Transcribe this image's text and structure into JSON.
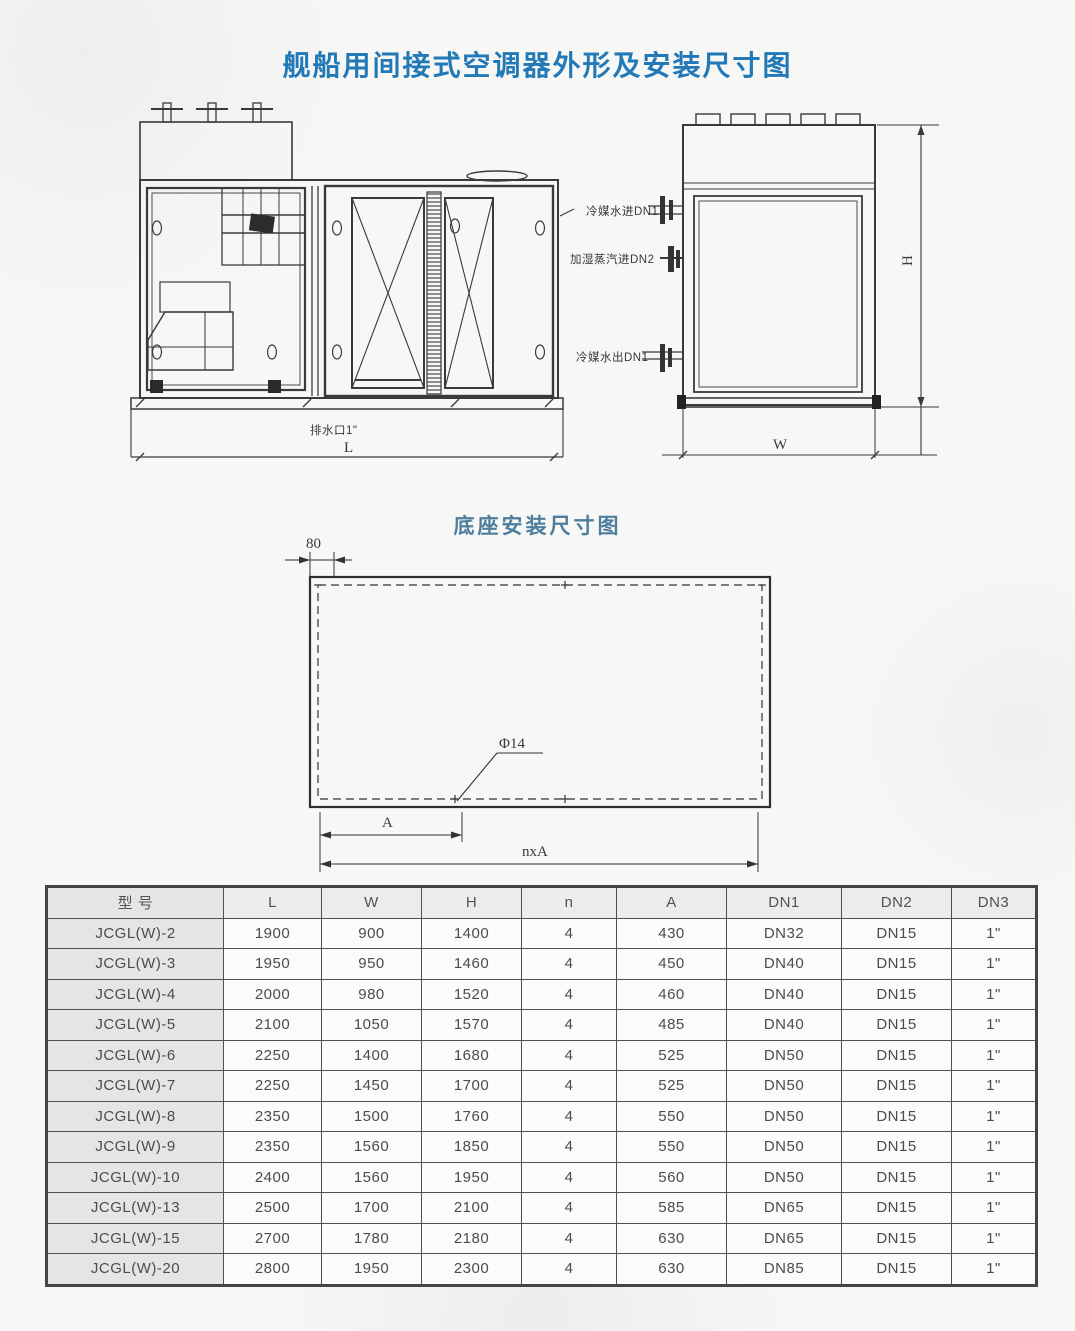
{
  "page": {
    "main_title": "舰船用间接式空调器外形及安装尺寸图",
    "base_drawing_title": "底座安装尺寸图"
  },
  "outline_drawing": {
    "port_labels": {
      "chilled_water_inlet": "冷媒水进DN1",
      "humidify_steam_inlet": "加湿蒸汽进DN2",
      "chilled_water_outlet": "冷媒水出DN1",
      "drain_port": "排水口1\""
    },
    "dim_labels": {
      "length": "L",
      "width": "W",
      "height": "H"
    }
  },
  "base_drawing": {
    "dim_labels": {
      "edge_offset": "80",
      "hole_diameter": "Φ14",
      "hole_pitch": "A",
      "total_span": "nxA"
    }
  },
  "spec_table": {
    "headers": [
      "型  号",
      "L",
      "W",
      "H",
      "n",
      "A",
      "DN1",
      "DN2",
      "DN3"
    ],
    "rows": [
      [
        "JCGL(W)-2",
        "1900",
        "900",
        "1400",
        "4",
        "430",
        "DN32",
        "DN15",
        "1\""
      ],
      [
        "JCGL(W)-3",
        "1950",
        "950",
        "1460",
        "4",
        "450",
        "DN40",
        "DN15",
        "1\""
      ],
      [
        "JCGL(W)-4",
        "2000",
        "980",
        "1520",
        "4",
        "460",
        "DN40",
        "DN15",
        "1\""
      ],
      [
        "JCGL(W)-5",
        "2100",
        "1050",
        "1570",
        "4",
        "485",
        "DN40",
        "DN15",
        "1\""
      ],
      [
        "JCGL(W)-6",
        "2250",
        "1400",
        "1680",
        "4",
        "525",
        "DN50",
        "DN15",
        "1\""
      ],
      [
        "JCGL(W)-7",
        "2250",
        "1450",
        "1700",
        "4",
        "525",
        "DN50",
        "DN15",
        "1\""
      ],
      [
        "JCGL(W)-8",
        "2350",
        "1500",
        "1760",
        "4",
        "550",
        "DN50",
        "DN15",
        "1\""
      ],
      [
        "JCGL(W)-9",
        "2350",
        "1560",
        "1850",
        "4",
        "550",
        "DN50",
        "DN15",
        "1\""
      ],
      [
        "JCGL(W)-10",
        "2400",
        "1560",
        "1950",
        "4",
        "560",
        "DN50",
        "DN15",
        "1\""
      ],
      [
        "JCGL(W)-13",
        "2500",
        "1700",
        "2100",
        "4",
        "585",
        "DN65",
        "DN15",
        "1\""
      ],
      [
        "JCGL(W)-15",
        "2700",
        "1780",
        "2180",
        "4",
        "630",
        "DN65",
        "DN15",
        "1\""
      ],
      [
        "JCGL(W)-20",
        "2800",
        "1950",
        "2300",
        "4",
        "630",
        "DN85",
        "DN15",
        "1\""
      ]
    ]
  },
  "colors": {
    "title_blue": "#2279b8",
    "subtitle_blue": "#4e7e9e",
    "line_dark": "#3a3a3a",
    "table_border": "#4f4f4f",
    "shaded_cell": "#e5e5e3"
  }
}
